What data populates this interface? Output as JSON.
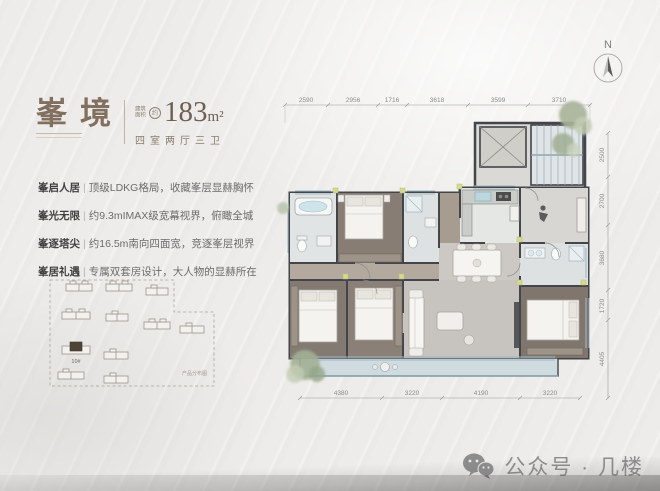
{
  "header": {
    "title": "峯境",
    "area_label_1": "建筑",
    "area_label_2": "面积",
    "approx": "约",
    "area_value": "183",
    "area_unit": "m²",
    "layout_text": "四室两厅三卫"
  },
  "features": [
    {
      "label": "峯启人居",
      "text": "顶级LDKG格局，收藏峯层显赫胸怀"
    },
    {
      "label": "峯光无限",
      "text": "约9.3mIMAX级宽幕视界，俯瞰全城"
    },
    {
      "label": "峯逐塔尖",
      "text": "约16.5m南向四面宽，竞逐峯层视界"
    },
    {
      "label": "峯居礼遇",
      "text": "专属双套房设计，大人物的显赫所在"
    }
  ],
  "siteplan": {
    "highlight_label": "10#",
    "caption": "产品分布图"
  },
  "compass": {
    "label": "N"
  },
  "floorplan": {
    "dims_top": [
      "2590",
      "2956",
      "1716",
      "3618",
      "3599",
      "3710"
    ],
    "dims_right": [
      "2500",
      "2700",
      "3680",
      "1720",
      "4405"
    ],
    "dims_bottom": [
      "4380",
      "3220",
      "4190",
      "3220"
    ]
  },
  "watermark": {
    "text": "公众号 · 几楼"
  },
  "colors": {
    "title": "#81705f",
    "wall": "#3f4246",
    "accent": "#d6da8f",
    "window": "#9db6c2"
  }
}
